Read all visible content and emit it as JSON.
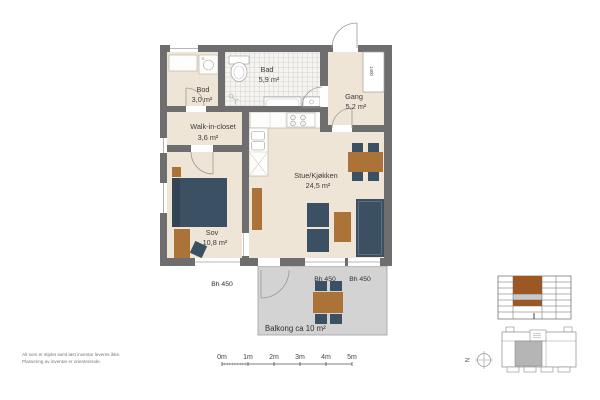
{
  "floorplan": {
    "rooms": {
      "bod": {
        "name": "Bod",
        "area": "3,0 m²"
      },
      "bad": {
        "name": "Bad",
        "area": "5,9 m²"
      },
      "gang": {
        "name": "Gang",
        "area": "5,2 m²"
      },
      "walk_in_closet": {
        "name": "Walk-in-closet",
        "area": "3,6 m²"
      },
      "sov": {
        "name": "Sov",
        "area": "10,8 m²"
      },
      "stue_kjokken": {
        "name": "Stue/Kjøkken",
        "area": "24,5 m²"
      },
      "balkong": {
        "name": "Balkong ca 10 m²"
      }
    },
    "labels": {
      "sill_sov": "Bh 450",
      "sill_balcony_left": "Bh 450",
      "sill_balcony_right": "Bh 450",
      "shaft_dimension": "1400"
    }
  },
  "scale_bar": {
    "ticks": [
      "0m",
      "1m",
      "2m",
      "3m",
      "4m",
      "5m"
    ]
  },
  "footnotes": {
    "line1": "Alt som er stiplet samt løst inventar leveres ikke.",
    "line2": "Plassering av inventar er orienterende."
  },
  "compass": {
    "north": "N"
  },
  "colors": {
    "wall": "#6e6e6e",
    "floor": "#efe5d6",
    "balcony_floor": "#d3d3d3",
    "furniture_dark": "#3c5063",
    "furniture_wood": "#ac7338",
    "keyplan_highlight": "#a1561e",
    "keyplan_muted": "#c9c9c9"
  }
}
